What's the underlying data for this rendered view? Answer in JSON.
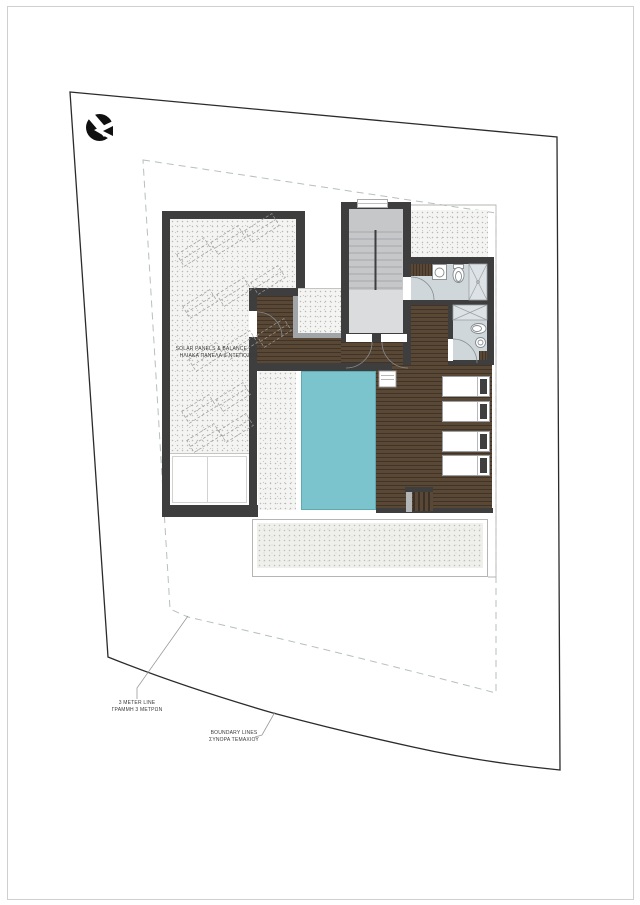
{
  "labels": {
    "solar": {
      "line1": "SOLAR PANELS & BALANCE TANK",
      "line2": "ΗΛΙΑΚΑ ΠΑΝΕΛΑ & ΝΤΕΠΟΖΙΤΑ"
    },
    "meter": {
      "line1": "3 METER LINE",
      "line2": "ΓΡΑΜΜΗ 3 ΜΕΤΡΩΝ"
    },
    "boundary": {
      "line1": "BOUNDARY LINES",
      "line2": "ΣΥΝΟΡΑ ΤΕΜΑΧΙΟΥ"
    }
  },
  "icons": {
    "logo": "studio-logo-icon"
  },
  "colors": {
    "wall": "#3e3e3e",
    "wood": "#5a4836",
    "pool": "#7cc4cd",
    "pooledge": "#5fa9b3",
    "tile": "#cfd7db",
    "shower": "#dce2e5",
    "stair": "#c5c7c9",
    "landing": "#dadcde",
    "stipple": "#f4f4f2",
    "terrace": "#efefec",
    "skyborder": "#a2a5a7",
    "fixture": "#858b90",
    "setback": "#b6c0bc",
    "boundary": "#2b2b2b",
    "outline": "#b5b5b3",
    "leader": "#9b9b9b",
    "panel": "#9b9b9b",
    "logo": "#101010",
    "text": "#3a3a3a"
  }
}
